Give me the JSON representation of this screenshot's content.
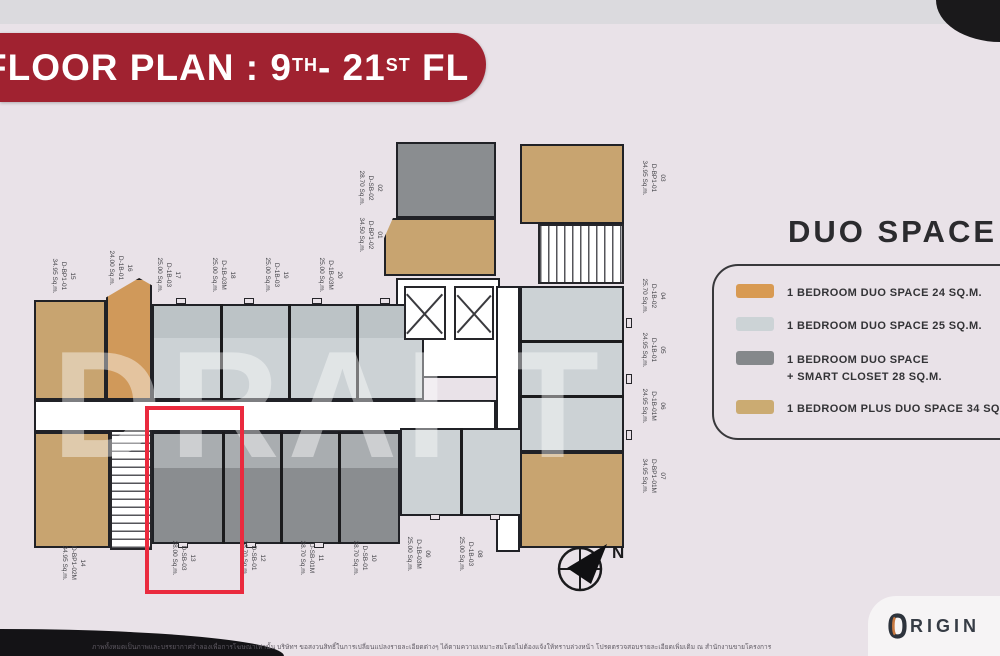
{
  "banner": {
    "title_prefix": "FLOOR PLAN : 9",
    "title_sup1": "TH",
    "title_mid": "- 21",
    "title_sup2": "ST",
    "title_suffix": " FL"
  },
  "legend": {
    "title": "DUO SPACE",
    "items": [
      {
        "color": "#d89a52",
        "label": "1 BEDROOM DUO SPACE 24 SQ.M."
      },
      {
        "color": "#ccd3d6",
        "label": "1 BEDROOM DUO SPACE 25 SQ.M."
      },
      {
        "color": "#85888b",
        "label": "1 BEDROOM DUO SPACE",
        "label2": "+ SMART CLOSET 28 SQ.M."
      },
      {
        "color": "#cbab72",
        "label": "1 BEDROOM PLUS DUO SPACE 34 SQ.M."
      }
    ]
  },
  "plan": {
    "watermark": "DRAFT",
    "units": [
      {
        "id": "01",
        "model": "D-BP1-02",
        "area": "34.50 Sq.m."
      },
      {
        "id": "02",
        "model": "D-SB-02",
        "area": "28.70 Sq.m."
      },
      {
        "id": "03",
        "model": "D-BP1-01",
        "area": "34.95 Sq.m."
      },
      {
        "id": "04",
        "model": "D-1B-02",
        "area": "25.70 Sq.m."
      },
      {
        "id": "05",
        "model": "D-1B-01",
        "area": "24.95 Sq.m."
      },
      {
        "id": "06",
        "model": "D-1B-01M",
        "area": "24.95 Sq.m."
      },
      {
        "id": "07",
        "model": "D-BP1-01M",
        "area": "34.95 Sq.m."
      },
      {
        "id": "08",
        "model": "D-1B-03",
        "area": "25.00 Sq.m."
      },
      {
        "id": "09",
        "model": "D-1B-03M",
        "area": "25.00 Sq.m."
      },
      {
        "id": "10",
        "model": "D-SB-01",
        "area": "28.70 Sq.m."
      },
      {
        "id": "11",
        "model": "D-SB-01M",
        "area": "28.70 Sq.m."
      },
      {
        "id": "12",
        "model": "D-SB-01",
        "area": "28.70 Sq.m."
      },
      {
        "id": "13",
        "model": "D-SB-03",
        "area": "28.00 Sq.m."
      },
      {
        "id": "14",
        "model": "D-BP1-02M",
        "area": "34.95 Sq.m."
      },
      {
        "id": "15",
        "model": "D-BP1-01",
        "area": "34.95 Sq.m."
      },
      {
        "id": "16",
        "model": "D-1B-01",
        "area": "24.00 Sq.m."
      },
      {
        "id": "17",
        "model": "D-1B-03",
        "area": "25.00 Sq.m."
      },
      {
        "id": "18",
        "model": "D-1B-03M",
        "area": "25.00 Sq.m."
      },
      {
        "id": "19",
        "model": "D-1B-03",
        "area": "25.00 Sq.m."
      },
      {
        "id": "20",
        "model": "D-1B-03M",
        "area": "25.00 Sq.m."
      }
    ]
  },
  "compass": {
    "label": "N"
  },
  "footer": {
    "disclaimer": "ภาพทั้งหมดเป็นภาพและบรรยากาศจำลองเพื่อการโฆษณาเท่านั้น บริษัทฯ ขอสงวนสิทธิ์ในการเปลี่ยนแปลงรายละเอียดต่างๆ ได้ตามความเหมาะสมโดยไม่ต้องแจ้งให้ทราบล่วงหน้า โปรดตรวจสอบรายละเอียดเพิ่มเติม ณ สำนักงานขายโครงการ",
    "brand": "ORIGIN",
    "brand_rest": "RIGIN"
  }
}
